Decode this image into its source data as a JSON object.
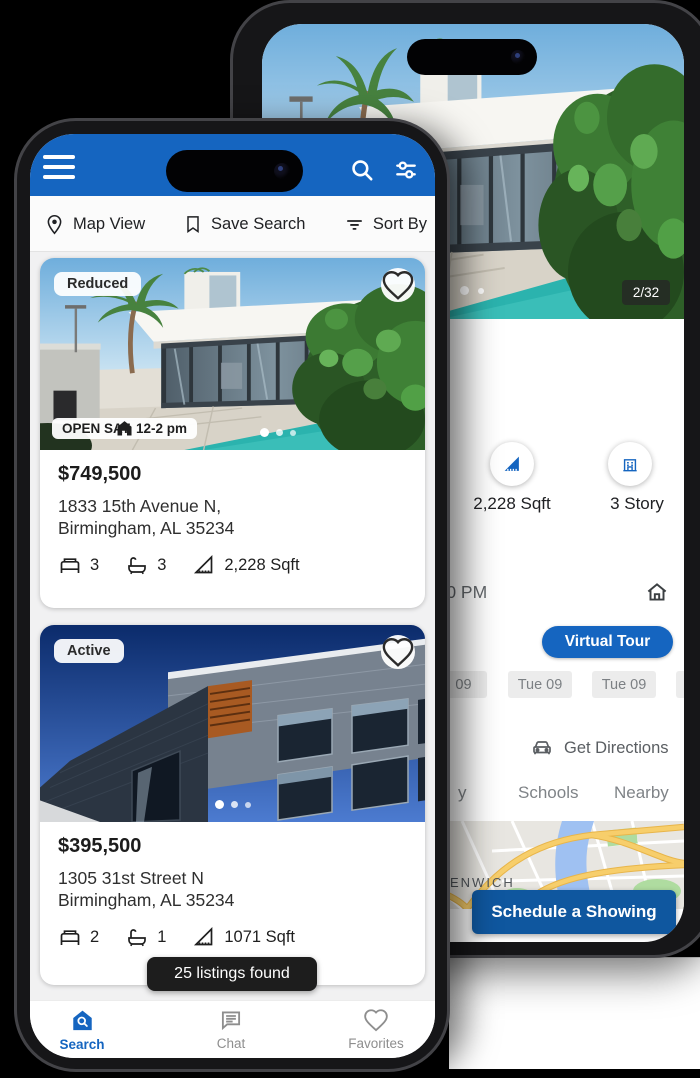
{
  "colors": {
    "primary": "#1565C0",
    "toast_bg": "#1d1d1d",
    "chip_bg": "#ececec"
  },
  "detail_phone": {
    "photo_counter": "2/32",
    "stats": [
      {
        "label": "2,228 Sqft"
      },
      {
        "label": "3 Story"
      }
    ],
    "time": "2:00 PM",
    "virtual_tour": "Virtual Tour",
    "date_chips": [
      "09",
      "Tue 09",
      "Tue 09",
      ""
    ],
    "get_directions": "Get Directions",
    "tabs": [
      "y",
      "Schools",
      "Nearby"
    ],
    "map_label": "ENWICH",
    "schedule_button": "Schedule a Showing"
  },
  "search_phone": {
    "toolbar": {
      "map_view": "Map View",
      "save_search": "Save Search",
      "sort_by": "Sort By"
    },
    "listings": [
      {
        "status": "Reduced",
        "open_house": "OPEN SAT, 12-2 pm",
        "price": "$749,500",
        "address1": "1833 15th Avenue N,",
        "address2": "Birmingham, AL 35234",
        "beds": "3",
        "baths": "3",
        "sqft": "2,228 Sqft"
      },
      {
        "status": "Active",
        "price": "$395,500",
        "address1": "1305 31st Street N",
        "address2": "Birmingham, AL 35234",
        "beds": "2",
        "baths": "1",
        "sqft": "1071 Sqft"
      }
    ],
    "toast": "25 listings found",
    "nav": [
      {
        "label": "Search"
      },
      {
        "label": "Chat"
      },
      {
        "label": "Favorites"
      }
    ]
  }
}
